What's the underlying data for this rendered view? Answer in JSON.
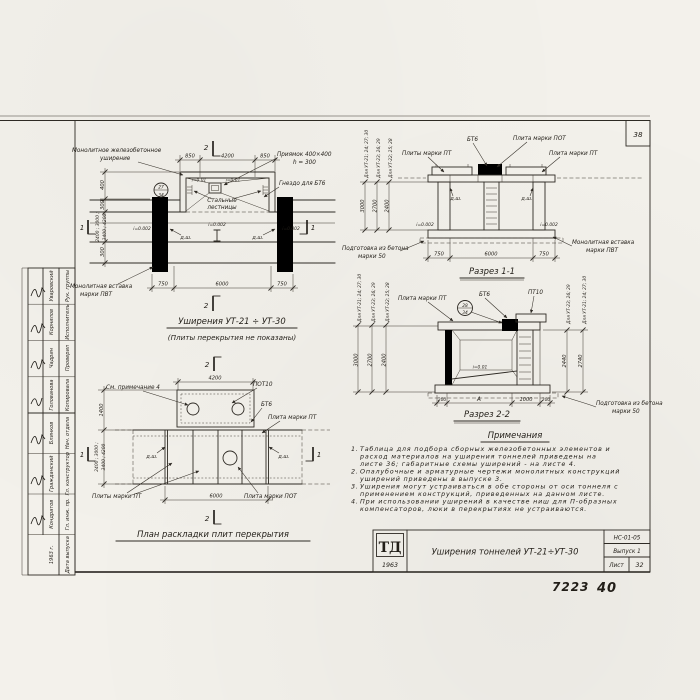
{
  "sheet": {
    "corner_number": "38",
    "handwritten_code": "7223",
    "handwritten_page": "40"
  },
  "title_block": {
    "logo_top": "ТД",
    "logo_year": "1963",
    "title": "Уширения тоннелей УТ-21÷УТ-30",
    "code": "НС-01-05",
    "issue": "Выпуск 1",
    "sheet_word": "Лист",
    "sheet_num": "32"
  },
  "stamp": {
    "upper": [
      {
        "role": "Рук. группы",
        "name": "Уваровский"
      },
      {
        "role": "Исполнитель",
        "name": "Корнилов"
      },
      {
        "role": "Проверил",
        "name": "Чадрин"
      },
      {
        "role": "Копировала",
        "name": "Голованова"
      }
    ],
    "lower": [
      {
        "role": "Нач. отдела",
        "name": "Блинков"
      },
      {
        "role": "Гл. конструктор",
        "name": "Гражданский"
      },
      {
        "role": "Гл. инж. пр.",
        "name": "Кондратов"
      },
      {
        "role": "Дата выпуска",
        "name": "1963 г."
      }
    ]
  },
  "plan": {
    "title": "Уширения  УТ-21 ÷ УТ-30",
    "subtitle": "(Плиты перекрытия не показаны)",
    "lbl_widening1": "Монолитное железобетонное",
    "lbl_widening2": "уширение",
    "lbl_pit1": "Приямок 400×400",
    "lbl_pit2": "h = 300",
    "lbl_socket": "Гнездо для БТ6",
    "lbl_ladder1": "Стальные",
    "lbl_ladder2": "лестницы",
    "lbl_insert1": "Монолитная вставка",
    "lbl_insert2": "марки ПВТ",
    "slope_pit": "i=0.01",
    "slope_floor": "i=0.002",
    "joint": "д.ш.",
    "detail_num": "27",
    "detail_sheet": "34",
    "dim_850": "850",
    "dim_4200": "4200",
    "dim_750": "750",
    "dim_6000": "6000",
    "dim_400": "400",
    "dim_300a": "300",
    "dim_300b": "300",
    "dim_stack1": "2400 ; 3000 ;",
    "dim_stack2": "3400 ; 4200",
    "mark2": "2",
    "mark1": "1"
  },
  "section1": {
    "title": "Разрез 1-1",
    "lbl_bt6": "БТ6",
    "lbl_pot": "Плита марки ПОТ",
    "lbl_pt_left": "Плиты марки ПТ",
    "lbl_pt_right": "Плита марки ПТ",
    "lbl_prep1": "Подготовка из бетона",
    "lbl_prep2": "марки 50",
    "lbl_insert1": "Монолитная вставка",
    "lbl_insert2": "марки ПВТ",
    "joint": "д.ш.",
    "slope": "i=0.002",
    "dim_750": "750",
    "dim_6000": "6000",
    "heights": [
      "3000",
      "2700",
      "2400"
    ],
    "height_labels": [
      "Для УТ-21; 24; 27; 30",
      "Для УТ-23; 26; 29",
      "Для УТ-22; 25; 28"
    ]
  },
  "section2": {
    "title": "Разрез 2-2",
    "lbl_pt": "Плита марки ПТ",
    "lbl_bt6": "БТ6",
    "lbl_pt10": "ПТ10",
    "lbl_prep1": "Подготовка из бетона",
    "lbl_prep2": "марки 50",
    "slope": "i=0.01",
    "detail_num": "28",
    "detail_sheet": "34",
    "dim_200l": "200",
    "dim_a": "А",
    "dim_1000": "1000",
    "dim_200r": "200",
    "heights_left": [
      "3000",
      "2700",
      "2400"
    ],
    "height_labels_left": [
      "Для УТ-21; 24; 27; 30",
      "Для УТ-23; 26; 29",
      "Для УТ-22; 25; 28"
    ],
    "heights_right": [
      "2440",
      "2740"
    ],
    "height_labels_right": [
      "Для УТ-23; 26; 29",
      "Для УТ-21; 24; 27; 30"
    ]
  },
  "slab_plan": {
    "title": "План раскладки плит перекрытия",
    "lbl_note": "См. примечание 4",
    "lbl_pot10": "ПОТ10",
    "lbl_bt6": "БТ6",
    "lbl_pt_right": "Плита марки ПТ",
    "lbl_pt_bottom": "Плиты марки ПТ",
    "lbl_pot_bottom": "Плита марки ПОТ",
    "joint": "д.ш.",
    "dim_4200": "4200",
    "dim_6000": "6000",
    "dim_1400": "1400",
    "dim_stack1": "2400 ; 3000 ;",
    "dim_stack2": "3400 ; 4200",
    "mark2": "2",
    "mark1": "1"
  },
  "notes": {
    "title": "Примечания",
    "items": [
      {
        "num": "1.",
        "lines": [
          "Таблица для подбора сборных железобетонных элементов и",
          "расход материалов на уширения тоннелей приведены на",
          "листе 36; габаритные схемы уширений - на листе 4."
        ]
      },
      {
        "num": "2.",
        "lines": [
          "Опалубочные и арматурные чертежи монолитных конструкций",
          "уширений приведены в выпуске 3."
        ]
      },
      {
        "num": "3.",
        "lines": [
          "Уширения могут устраиваться в обе стороны от оси тоннеля с",
          "применением конструкций, приведенных на данном листе."
        ]
      },
      {
        "num": "4.",
        "lines": [
          "При использовании уширений в качестве ниш для П-образных",
          "компенсаторов, люки в перекрытиях не устраиваются."
        ]
      }
    ]
  }
}
